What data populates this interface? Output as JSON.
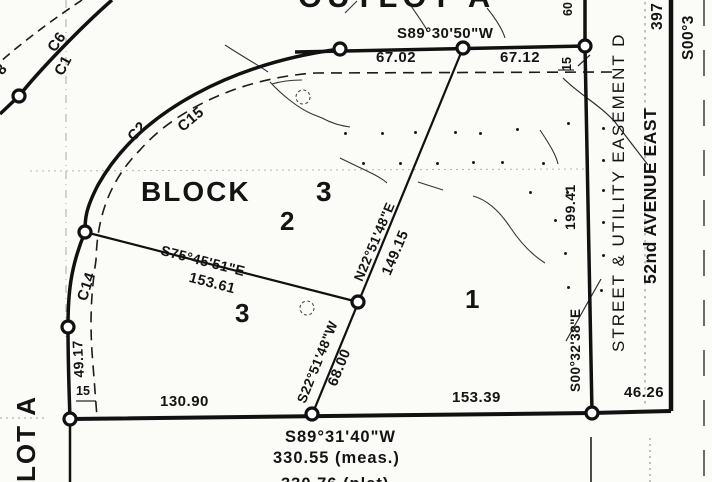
{
  "map": {
    "type": "survey-plat",
    "outlot_title": "OUTLOT A",
    "block": {
      "word": "BLOCK",
      "number": "3"
    },
    "lot_numbers": [
      "1",
      "2",
      "3"
    ],
    "street_names": [
      "52nd AVENUE EAST"
    ],
    "easement_note": "STREET & UTILITY EASEMENT D",
    "left_outlot_label": "LOT A",
    "bearings": {
      "north_line": "S89°30'50\"W",
      "south_line": "S89°31'40\"W",
      "east_line": "S00°32'38\"E",
      "lot_line_75": "S75°45'51\"E",
      "lot_line_n22": "N22°51'48\"E",
      "lot_line_s22": "S22°51'48\"W",
      "right_edge_partial": "S00°3"
    },
    "distances": {
      "north_segments": [
        "67.02",
        "67.12"
      ],
      "south_total_meas": "330.55 (meas.)",
      "south_total_plat": "330.76 (plat)",
      "south_segments": [
        "130.90",
        "153.39",
        "46.26"
      ],
      "east_line": "199.41",
      "lot_line_75": "153.61",
      "lot_line_n22": "149.15",
      "lot_line_s22": "68.00",
      "curve_segment": "49.17",
      "right_edge_partial": "397",
      "easement_width_ticks": [
        "15",
        "15"
      ],
      "row_half_width": "60"
    },
    "curve_labels": [
      "C6",
      "C1",
      "C2",
      "C15",
      "C14"
    ],
    "colors": {
      "ink": "#141414",
      "paper": "#fbfbf8",
      "faint": "#999999"
    }
  },
  "labels": [
    {
      "name": "outlot-title",
      "text": "OUTLOT A",
      "x": 298,
      "y": -19,
      "rot": 0,
      "size": 31,
      "ls": 5
    },
    {
      "name": "bearing-north",
      "text": "S89°30'50\"W",
      "x": 397,
      "y": 26,
      "rot": 0,
      "size": 15,
      "ls": 0.5
    },
    {
      "name": "dist-67-02",
      "text": "67.02",
      "x": 376,
      "y": 50,
      "rot": 0,
      "size": 15,
      "ls": 0.5
    },
    {
      "name": "dist-67-12",
      "text": "67.12",
      "x": 500,
      "y": 50,
      "rot": 0,
      "size": 15,
      "ls": 0.5
    },
    {
      "name": "block-word",
      "text": "BLOCK",
      "x": 141,
      "y": 177,
      "rot": 0,
      "size": 28,
      "ls": 2
    },
    {
      "name": "block-number",
      "text": "3",
      "x": 316,
      "y": 177,
      "rot": 0,
      "size": 28,
      "ls": 0
    },
    {
      "name": "lot-2-number",
      "text": "2",
      "x": 280,
      "y": 208,
      "rot": 0,
      "size": 26,
      "ls": 0
    },
    {
      "name": "lot-3-number",
      "text": "3",
      "x": 235,
      "y": 300,
      "rot": 0,
      "size": 26,
      "ls": 0
    },
    {
      "name": "lot-1-number",
      "text": "1",
      "x": 465,
      "y": 286,
      "rot": 0,
      "size": 26,
      "ls": 0
    },
    {
      "name": "bearing-75",
      "text": "S75°45'51\"E",
      "x": 163,
      "y": 243,
      "rot": 14.5,
      "size": 14,
      "ls": 0.5
    },
    {
      "name": "dist-153-61",
      "text": "153.61",
      "x": 191,
      "y": 271,
      "rot": 14.5,
      "size": 14.5,
      "ls": 0.5
    },
    {
      "name": "bearing-n22",
      "text": "N22°51'48\"E",
      "x": 352,
      "y": 278,
      "rot": -67,
      "size": 13.5,
      "ls": 0.5
    },
    {
      "name": "dist-149-15",
      "text": "149.15",
      "x": 380,
      "y": 272,
      "rot": -67,
      "size": 14.5,
      "ls": 0.5
    },
    {
      "name": "bearing-s22",
      "text": "S22°51'48\"W",
      "x": 295,
      "y": 400,
      "rot": -68,
      "size": 13.5,
      "ls": 0.5
    },
    {
      "name": "dist-68-00",
      "text": "68.00",
      "x": 326,
      "y": 383,
      "rot": -68,
      "size": 14.5,
      "ls": 0.5
    },
    {
      "name": "dist-130-90",
      "text": "130.90",
      "x": 160,
      "y": 394,
      "rot": 0,
      "size": 15,
      "ls": 0.5
    },
    {
      "name": "dist-153-39",
      "text": "153.39",
      "x": 452,
      "y": 390,
      "rot": 0,
      "size": 15,
      "ls": 0.5
    },
    {
      "name": "dist-46-26",
      "text": "46.26",
      "x": 624,
      "y": 385,
      "rot": 0,
      "size": 15,
      "ls": 0.5
    },
    {
      "name": "bearing-south",
      "text": "S89°31'40\"W",
      "x": 285,
      "y": 429,
      "rot": 0,
      "size": 16.5,
      "ls": 1
    },
    {
      "name": "dist-south-meas",
      "text": "330.55 (meas.)",
      "x": 273,
      "y": 450,
      "rot": 0,
      "size": 16.5,
      "ls": 1
    },
    {
      "name": "dist-south-plat",
      "text": "330.76 (plat)",
      "x": 281,
      "y": 476,
      "rot": 0,
      "size": 16.5,
      "ls": 1
    },
    {
      "name": "curve-c6",
      "text": "C6",
      "x": 45,
      "y": 46,
      "rot": -55,
      "size": 15,
      "ls": 0.5
    },
    {
      "name": "curve-c1",
      "text": "C1",
      "x": 52,
      "y": 71,
      "rot": -62,
      "size": 15,
      "ls": 0.5
    },
    {
      "name": "curve-c2",
      "text": "C2",
      "x": 125,
      "y": 134,
      "rot": -48,
      "size": 15,
      "ls": 0.5
    },
    {
      "name": "curve-c15",
      "text": "C15",
      "x": 175,
      "y": 123,
      "rot": -40,
      "size": 15,
      "ls": 0.5
    },
    {
      "name": "curve-c14",
      "text": "C14",
      "x": 75,
      "y": 298,
      "rot": -72,
      "size": 15,
      "ls": 0.5
    },
    {
      "name": "dist-49-17",
      "text": "49.17",
      "x": 72,
      "y": 378,
      "rot": -93,
      "size": 14,
      "ls": 0.5
    },
    {
      "name": "tick-15-left",
      "text": "15",
      "x": 76,
      "y": 385,
      "rot": 0,
      "size": 12.5,
      "ls": 0
    },
    {
      "name": "lot-a-label",
      "text": "LOT A",
      "x": 13,
      "y": 482,
      "rot": -90,
      "size": 26,
      "ls": 2
    },
    {
      "name": "dist-199-41",
      "text": "199.41",
      "x": 563,
      "y": 230,
      "rot": -90,
      "size": 14,
      "ls": 0.5
    },
    {
      "name": "bearing-s00",
      "text": "S00°32'38\"E",
      "x": 569,
      "y": 392,
      "rot": -90,
      "size": 13.5,
      "ls": 0.5
    },
    {
      "name": "tick-15-top",
      "text": "15",
      "x": 561,
      "y": 71,
      "rot": -90,
      "size": 12.5,
      "ls": 0
    },
    {
      "name": "dim-60",
      "text": "60",
      "x": 562,
      "y": 16,
      "rot": -90,
      "size": 12.5,
      "ls": 0
    },
    {
      "name": "easement-note",
      "text": "STREET & UTILITY EASEMENT D",
      "x": 610,
      "y": 352,
      "rot": -90,
      "size": 17,
      "ls": 2,
      "w": 400
    },
    {
      "name": "street-52nd-avenue",
      "text": "52nd AVENUE EAST",
      "x": 641,
      "y": 284,
      "rot": -90,
      "size": 17.5,
      "ls": 0.5
    },
    {
      "name": "dim-397",
      "text": "397",
      "x": 650,
      "y": 30,
      "rot": -90,
      "size": 15.5,
      "ls": 0.5
    },
    {
      "name": "bearing-right-edge",
      "text": "S00°3",
      "x": 681,
      "y": 60,
      "rot": -90,
      "size": 15.5,
      "ls": 0.5
    },
    {
      "name": "partial-curve-label",
      "text": "8",
      "x": -7,
      "y": 68,
      "rot": -50,
      "size": 15,
      "ls": 0
    }
  ],
  "stipple_dots": [
    [
      345,
      133
    ],
    [
      382,
      133
    ],
    [
      415,
      132
    ],
    [
      455,
      132
    ],
    [
      480,
      133
    ],
    [
      517,
      129
    ],
    [
      568,
      123
    ],
    [
      603,
      128
    ],
    [
      363,
      163
    ],
    [
      400,
      163
    ],
    [
      437,
      163
    ],
    [
      473,
      162
    ],
    [
      502,
      162
    ],
    [
      543,
      163
    ],
    [
      603,
      160
    ],
    [
      530,
      192
    ],
    [
      567,
      192
    ],
    [
      603,
      190
    ],
    [
      555,
      220
    ],
    [
      603,
      222
    ],
    [
      565,
      253
    ],
    [
      603,
      255
    ],
    [
      568,
      287
    ],
    [
      601,
      290
    ]
  ]
}
